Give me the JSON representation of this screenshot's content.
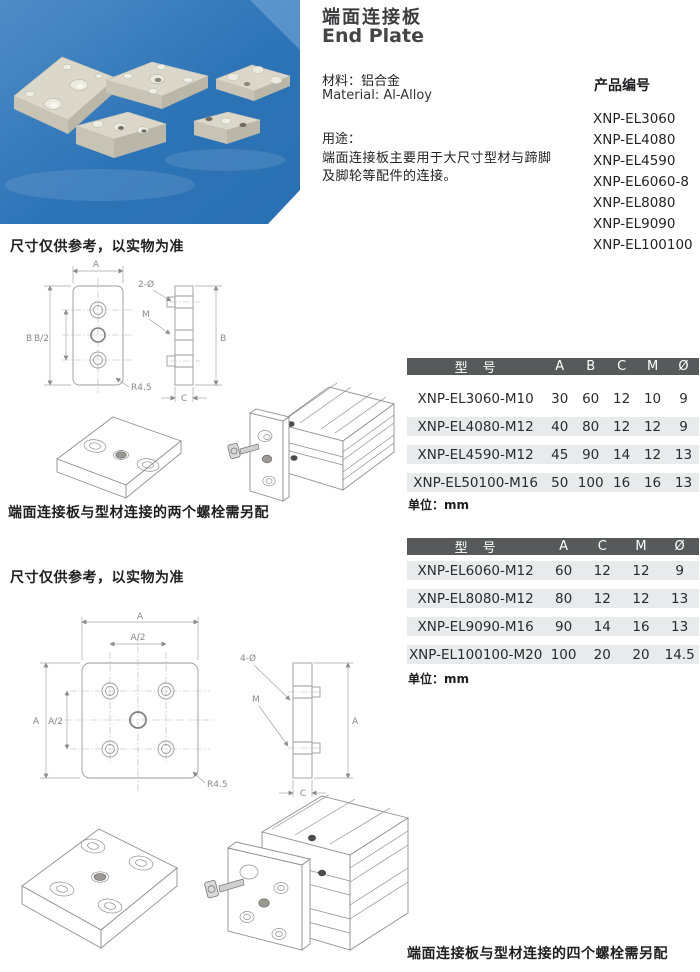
{
  "header": {
    "title_zh": "端面连接板",
    "title_en": "End Plate",
    "material_zh": "材料：铝合金",
    "material_en": "Material: Al-Alloy",
    "usage_title": "用途：",
    "usage_line1": "端面连接板主要用于大尺寸型材与蹄脚",
    "usage_line2": "及脚轮等配件的连接。",
    "codes_title": "产品编号",
    "codes": [
      "XNP-EL3060",
      "XNP-EL4080",
      "XNP-EL4590",
      "XNP-EL6060-8",
      "XNP-EL8080",
      "XNP-EL9090",
      "XNP-EL100100"
    ]
  },
  "notes": {
    "dimension_note": "尺寸仅供参考，以实物为准",
    "caption_two_bolts": "端面连接板与型材连接的两个螺栓需另配",
    "caption_four_bolts": "端面连接板与型材连接的四个螺栓需另配",
    "unit": "单位：mm"
  },
  "labels": {
    "A": "A",
    "B": "B",
    "C": "C",
    "M": "M",
    "A2": "A/2",
    "B2": "B/2",
    "two_dia": "2-Ø",
    "four_dia": "4-Ø",
    "radius": "R4.5"
  },
  "table1": {
    "headers": [
      "型　号",
      "A",
      "B",
      "C",
      "M",
      "Ø"
    ],
    "rows": [
      {
        "model": "XNP-EL3060-M10",
        "A": "30",
        "B": "60",
        "C": "12",
        "M": "10",
        "D": "9"
      },
      {
        "model": "XNP-EL4080-M12",
        "A": "40",
        "B": "80",
        "C": "12",
        "M": "12",
        "D": "9"
      },
      {
        "model": "XNP-EL4590-M12",
        "A": "45",
        "B": "90",
        "C": "14",
        "M": "12",
        "D": "13"
      },
      {
        "model": "XNP-EL50100-M16",
        "A": "50",
        "B": "100",
        "C": "16",
        "M": "16",
        "D": "13"
      }
    ]
  },
  "table2": {
    "headers": [
      "型　号",
      "A",
      "C",
      "M",
      "Ø"
    ],
    "rows": [
      {
        "model": "XNP-EL6060-M12",
        "A": "60",
        "C": "12",
        "M": "12",
        "D": "9"
      },
      {
        "model": "XNP-EL8080-M12",
        "A": "80",
        "C": "12",
        "M": "12",
        "D": "13"
      },
      {
        "model": "XNP-EL9090-M16",
        "A": "90",
        "C": "14",
        "M": "16",
        "D": "13"
      },
      {
        "model": "XNP-EL100100-M20",
        "A": "100",
        "C": "20",
        "M": "20",
        "D": "14.5"
      }
    ]
  },
  "colors": {
    "table_header_bg": "#58595B",
    "row_stripe": "#E9EAEB",
    "photo_blue": "#2F76B9",
    "plate_beige": "#D8D5C8"
  }
}
